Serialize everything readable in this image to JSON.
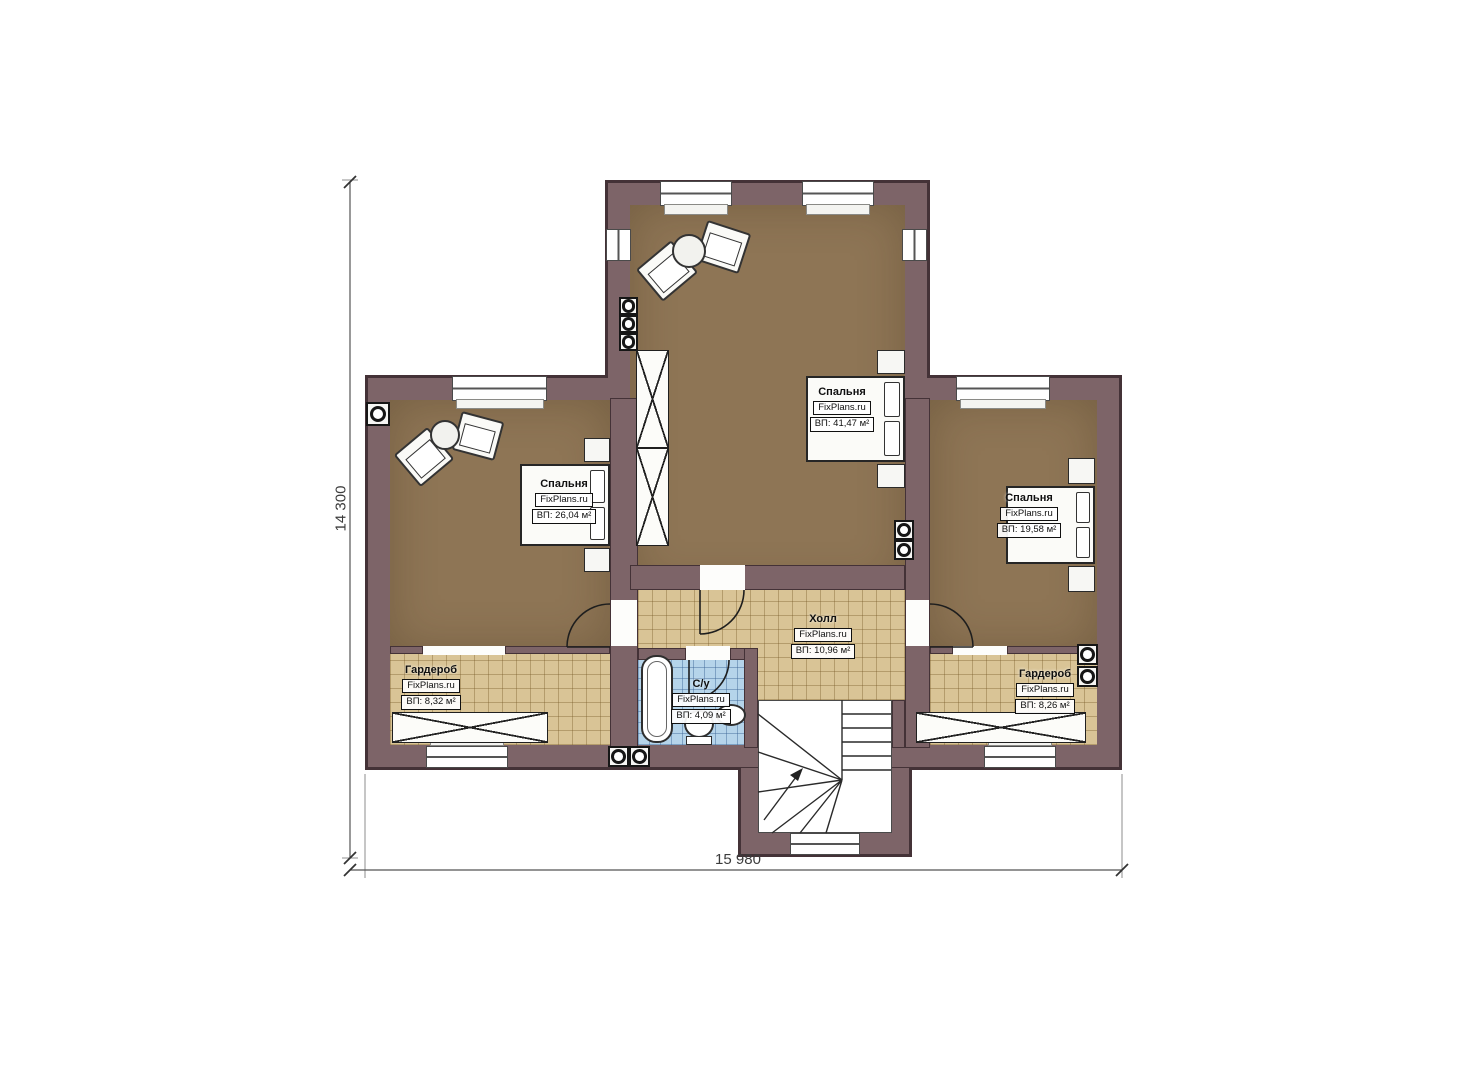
{
  "plan": {
    "watermark": "FixPlans.ru",
    "dimensions": {
      "height_label": "14 300",
      "width_label": "15 980"
    },
    "rooms": [
      {
        "name": "Спальня",
        "area": "ВП: 41,47 м²"
      },
      {
        "name": "Спальня",
        "area": "ВП: 26,04 м²"
      },
      {
        "name": "Спальня",
        "area": "ВП: 19,58 м²"
      },
      {
        "name": "Холл",
        "area": "ВП: 10,96 м²"
      },
      {
        "name": "С/у",
        "area": "ВП: 4,09 м²"
      },
      {
        "name": "Гардероб",
        "area": "ВП: 8,32 м²"
      },
      {
        "name": "Гардероб",
        "area": "ВП: 8,26 м²"
      }
    ],
    "colors": {
      "wall": "#7d6468",
      "wall_outline": "#443237",
      "floor_wood": "#8e7555",
      "floor_tile": "#d9c496",
      "floor_bath": "#b5d4ea"
    }
  }
}
